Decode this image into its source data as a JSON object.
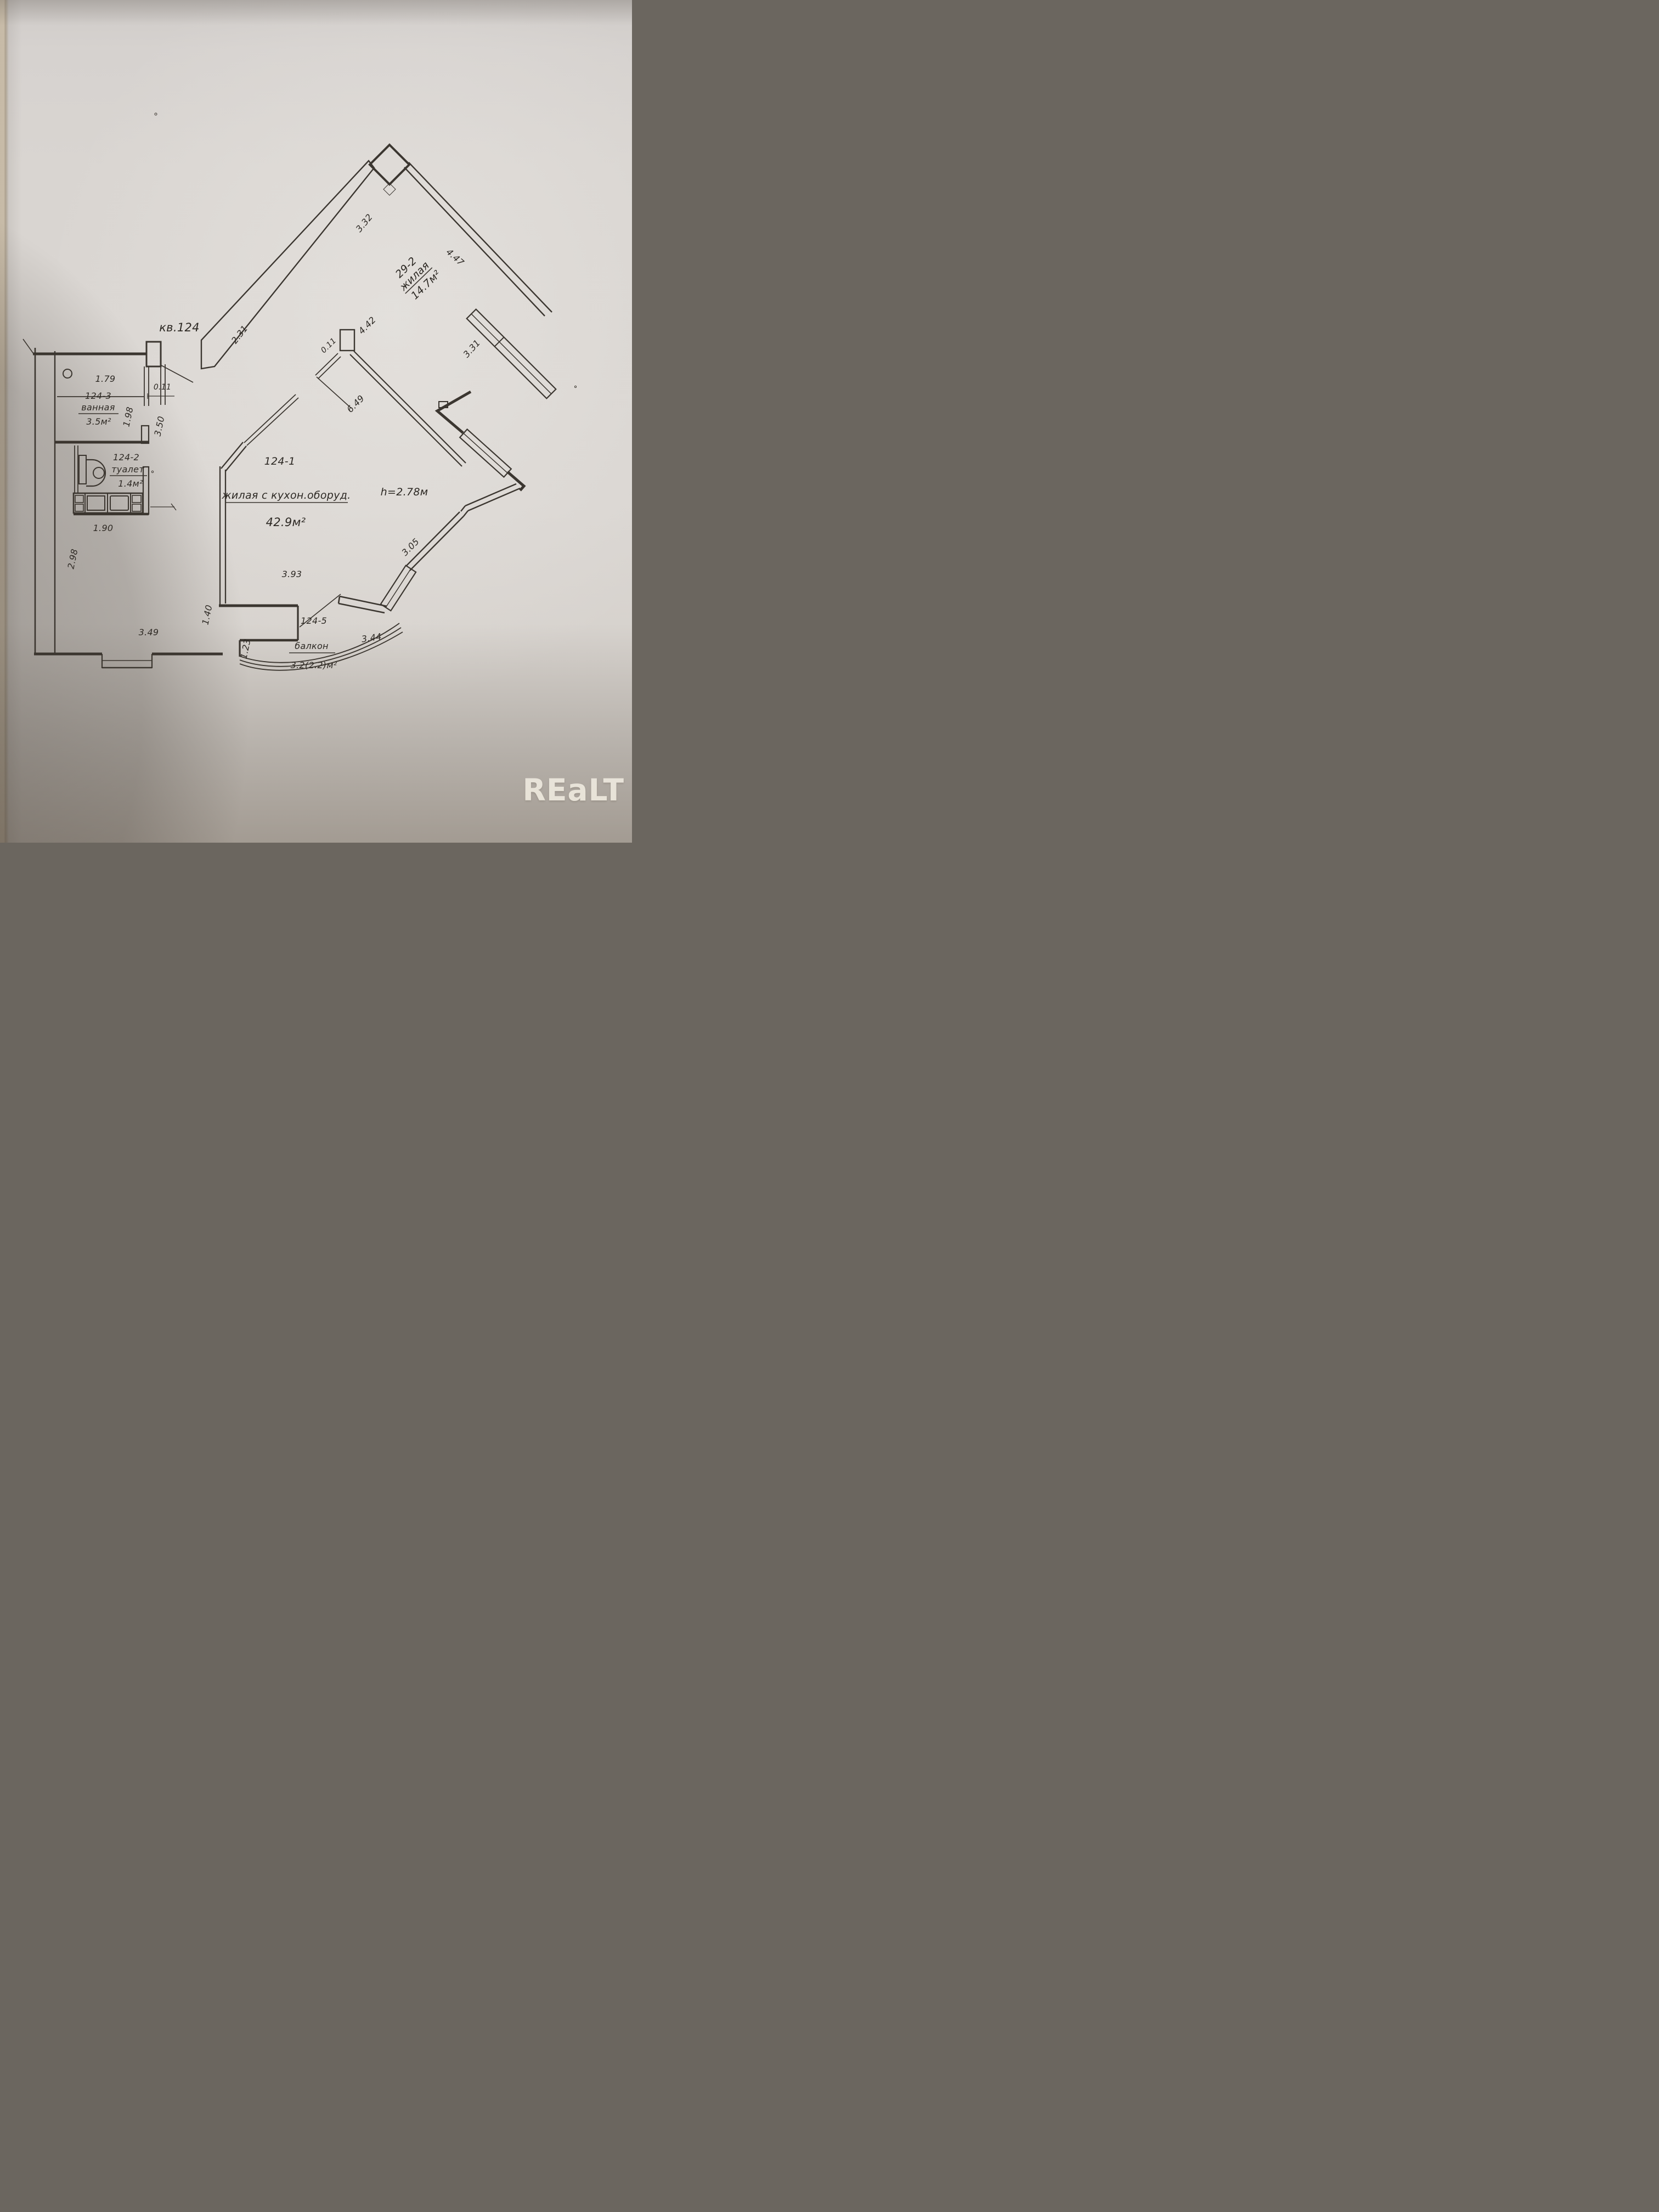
{
  "photo": {
    "watermark": "REaLT",
    "colors": {
      "paper": "#d9d5d1",
      "ink": "#3b3630",
      "watermark_color": "#ece7dc"
    }
  },
  "plan": {
    "apartment": "кв.124",
    "height_note": "h=2.78м",
    "rooms": {
      "zhilaya_29_2": {
        "id": "29-2",
        "name": "жилая",
        "area": "14.7м²"
      },
      "main_124_1": {
        "id": "124-1",
        "name": "жилая с кухон.оборуд.",
        "area": "42.9м²"
      },
      "toilet_124_2": {
        "id": "124-2",
        "name": "туалет",
        "area": "1.4м²"
      },
      "bath_124_3": {
        "id": "124-3",
        "name": "ванная",
        "area": "3.5м²"
      },
      "balcony_124_5": {
        "id": "124-5",
        "name": "балкон",
        "area": "3.2(2.2)м²"
      }
    },
    "dims": {
      "w332": "3.32",
      "w447": "4.47",
      "w231": "2.31",
      "w442": "4.42",
      "t011a": "0.11",
      "t011b": "0.11",
      "w649": "6.49",
      "w331": "3.31",
      "w179": "1.79",
      "w198": "1.98",
      "w350": "3.50",
      "w190": "1.90",
      "w298": "2.98",
      "w349": "3.49",
      "w140": "1.40",
      "w123": "1.23",
      "w393": "3.93",
      "w344": "3.44",
      "w305": "3.05"
    }
  }
}
